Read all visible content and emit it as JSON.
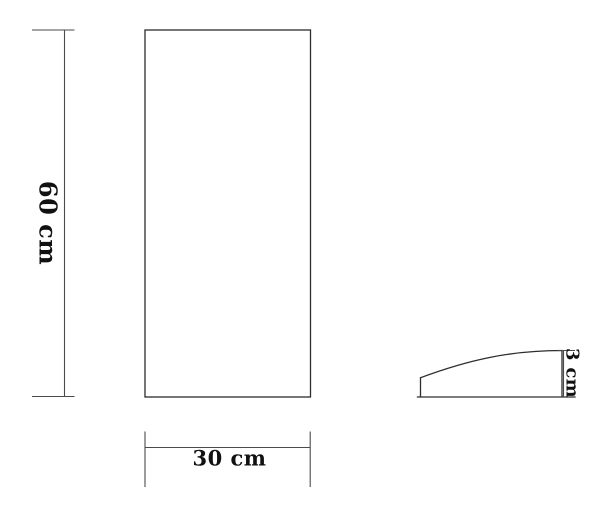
{
  "figure": {
    "type": "technical-drawing",
    "views": {
      "front": {
        "height_label": "60 cm",
        "width_label": "30 cm"
      },
      "side": {
        "thickness_label": "3 cm"
      }
    },
    "colors": {
      "background": "#ffffff",
      "outline": "#2d2d2d",
      "dimension_line": "#4a4a4a",
      "label_text": "#111111"
    }
  }
}
